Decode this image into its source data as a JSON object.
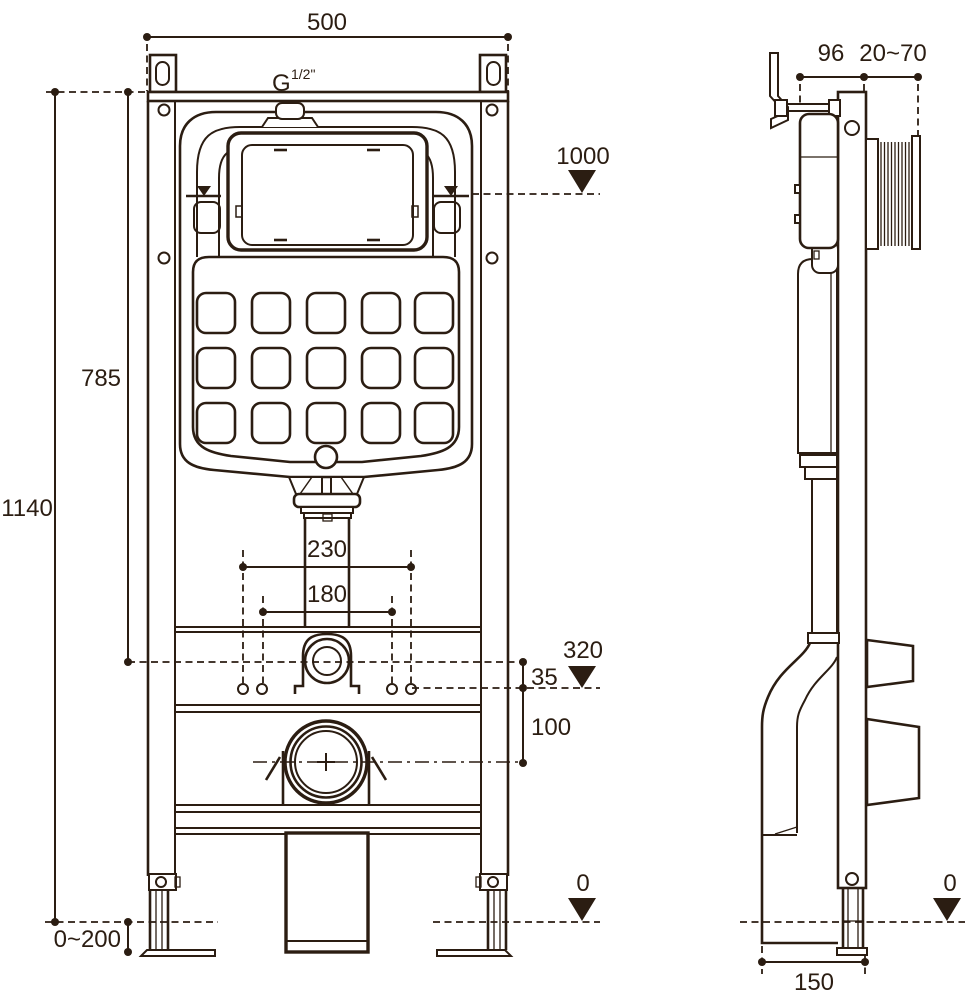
{
  "colors": {
    "ink": "#2b1d12",
    "background": "#ffffff"
  },
  "views": {
    "front": {
      "dim_frame_width": "500",
      "inlet_thread_prefix": "G",
      "inlet_thread_size": "1/2\"",
      "dim_flush_plate_level": "1000",
      "dim_top_to_inlet": "785",
      "dim_frame_height": "1140",
      "dim_fixing_span_outer": "230",
      "dim_fixing_span_inner": "180",
      "dim_inlet_level": "320",
      "dim_fixing_drop": "35",
      "dim_drain_drop": "100",
      "dim_foot_adjust": "0~200",
      "dim_floor_level": "0"
    },
    "side": {
      "dim_bracket_offset": "96",
      "dim_wall_clearance": "20~70",
      "dim_floor_level": "0",
      "dim_frame_depth": "150"
    }
  }
}
